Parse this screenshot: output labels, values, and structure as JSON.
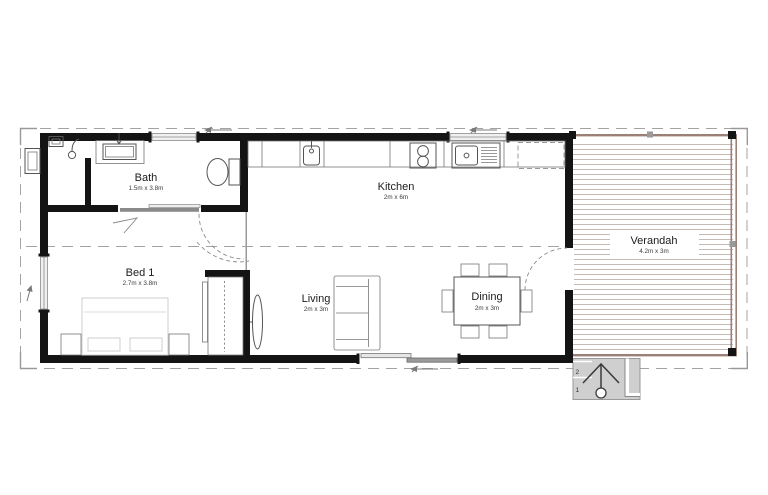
{
  "rooms": {
    "bath": {
      "name": "Bath",
      "dims": "1.5m x 3.8m"
    },
    "kitchen": {
      "name": "Kitchen",
      "dims": "2m x 6m"
    },
    "bed1": {
      "name": "Bed 1",
      "dims": "2.7m x 3.8m"
    },
    "living": {
      "name": "Living",
      "dims": "2m x 3m"
    },
    "dining": {
      "name": "Dining",
      "dims": "2m x 3m"
    },
    "verandah": {
      "name": "Verandah",
      "dims": "4.2m x 3m"
    }
  },
  "steps": {
    "tread_2": "2",
    "tread_1": "1"
  },
  "colors": {
    "wall": "#141414",
    "window_frame": "#8a8a8a",
    "deck_line": "#c6bab4",
    "deck_frame": "#9b8078",
    "steps_fill": "#cfcfcf",
    "roof_dashed": "#a3a3a3"
  }
}
